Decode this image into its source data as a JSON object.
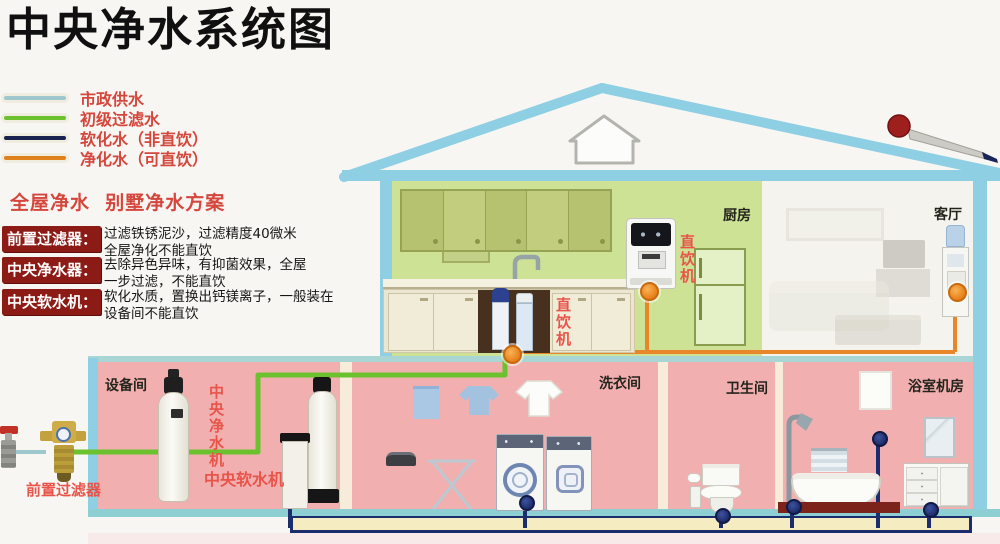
{
  "title": "中央净水系统图",
  "legend": [
    {
      "label": "市政供水",
      "color": "#9fc8ce"
    },
    {
      "label": "初级过滤水",
      "color": "#6cc22e"
    },
    {
      "label": "软化水（非直饮）",
      "color": "#1a2250"
    },
    {
      "label": "净化水（可直饮）",
      "color": "#e0821c"
    }
  ],
  "plan_title": "全屋净水  别墅净水方案",
  "glossary": [
    {
      "term": "前置过滤器：",
      "line1": "过滤铁锈泥沙，过滤精度40微米",
      "line2": "全屋净化不能直饮"
    },
    {
      "term": "中央净水器：",
      "line1": "去除异色异味，有抑菌效果，全屋",
      "line2": "一步过滤，不能直饮"
    },
    {
      "term": "中央软水机：",
      "line1": "软化水质，置换出钙镁离子，一般装在",
      "line2": "设备间不能直饮"
    }
  ],
  "rooms": {
    "kitchen": "厨房",
    "living": "客厅",
    "equipment": "设备间",
    "laundry": "洗衣间",
    "bathroom": "卫生间",
    "bath_machine": "浴室机房"
  },
  "labels": {
    "sink_purifier": "直饮机",
    "wall_dispenser": "直饮机",
    "central_purifier": "中央净水机",
    "central_softener": "中央软水机",
    "pre_filter": "前置过滤器"
  },
  "colors": {
    "municipal_pipe": "#9fc8ce",
    "filtered_pipe": "#6cc22e",
    "softened_pipe": "#1c2d6e",
    "purified_pipe": "#e8872a",
    "legend_text": "#d5463c",
    "badge_bg": "#8c1b16",
    "roof": "#8ecfe4",
    "kitchen_wall": "#cde295",
    "basement_room": "#f2afaf"
  }
}
